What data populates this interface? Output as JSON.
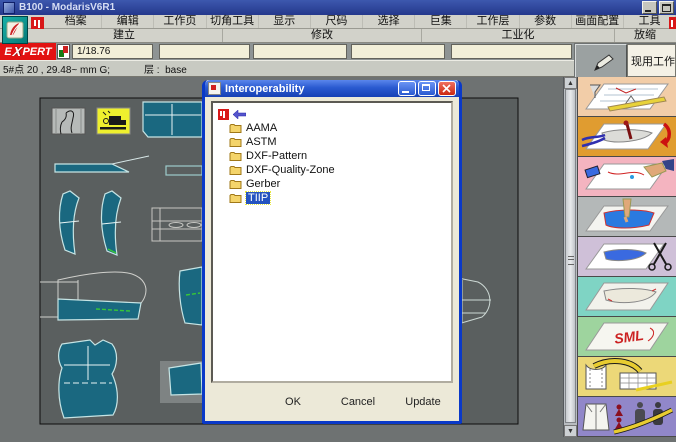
{
  "window": {
    "title": "B100 - ModarisV6R1"
  },
  "menu": {
    "items": [
      "档案",
      "编辑",
      "工作页",
      "切角工具",
      "显示",
      "尺码",
      "选择",
      "巨集",
      "工作层",
      "参数",
      "画面配置",
      "工具"
    ]
  },
  "sections": {
    "items": [
      "建立",
      "修改",
      "工业化",
      "放缩"
    ]
  },
  "toolbar": {
    "expert_e": "E",
    "expert_x": "X",
    "expert_rest": "PERT",
    "scale_field": "1/18.76",
    "active_page_button": "现用工作页"
  },
  "statusbar": {
    "coordinates": "5#点 20 , 29.48~ mm G;",
    "layer_label": "层 :",
    "layer_value": "base"
  },
  "dialog": {
    "title": "Interoperability",
    "items": [
      {
        "label": "AAMA",
        "selected": false
      },
      {
        "label": "ASTM",
        "selected": false
      },
      {
        "label": "DXF-Pattern",
        "selected": false
      },
      {
        "label": "DXF-Quality-Zone",
        "selected": false
      },
      {
        "label": "Gerber",
        "selected": false
      },
      {
        "label": "TIIP",
        "selected": true
      }
    ],
    "buttons": {
      "ok": "OK",
      "cancel": "Cancel",
      "update": "Update"
    }
  },
  "sidebar": {
    "tiles": [
      {
        "name": "flat-pattern-drafting",
        "color": "#f2cda8",
        "label": ""
      },
      {
        "name": "pattern-modification",
        "color": "#e09c30",
        "label": ""
      },
      {
        "name": "pattern-correction",
        "color": "#f4b4c0",
        "label": ""
      },
      {
        "name": "piece-extraction",
        "color": "#b4b8b8",
        "label": ""
      },
      {
        "name": "pattern-cutting",
        "color": "#cfc0d8",
        "label": ""
      },
      {
        "name": "marker-sheet",
        "color": "#7fd4c4",
        "label": ""
      },
      {
        "name": "grading-sizes",
        "color": "#9ed49e",
        "label": "SML"
      },
      {
        "name": "measurement-chart",
        "color": "#ecd878",
        "label": ""
      },
      {
        "name": "fitting-simulation",
        "color": "#9187c9",
        "label": ""
      }
    ]
  },
  "colors": {
    "piece_fill": "#1a6880",
    "selection_blue": "#2553c0",
    "canvas_bg": "#5a5f5f",
    "expert_red": "#e21212",
    "dialog_titlebar": "#2a5ad0"
  }
}
